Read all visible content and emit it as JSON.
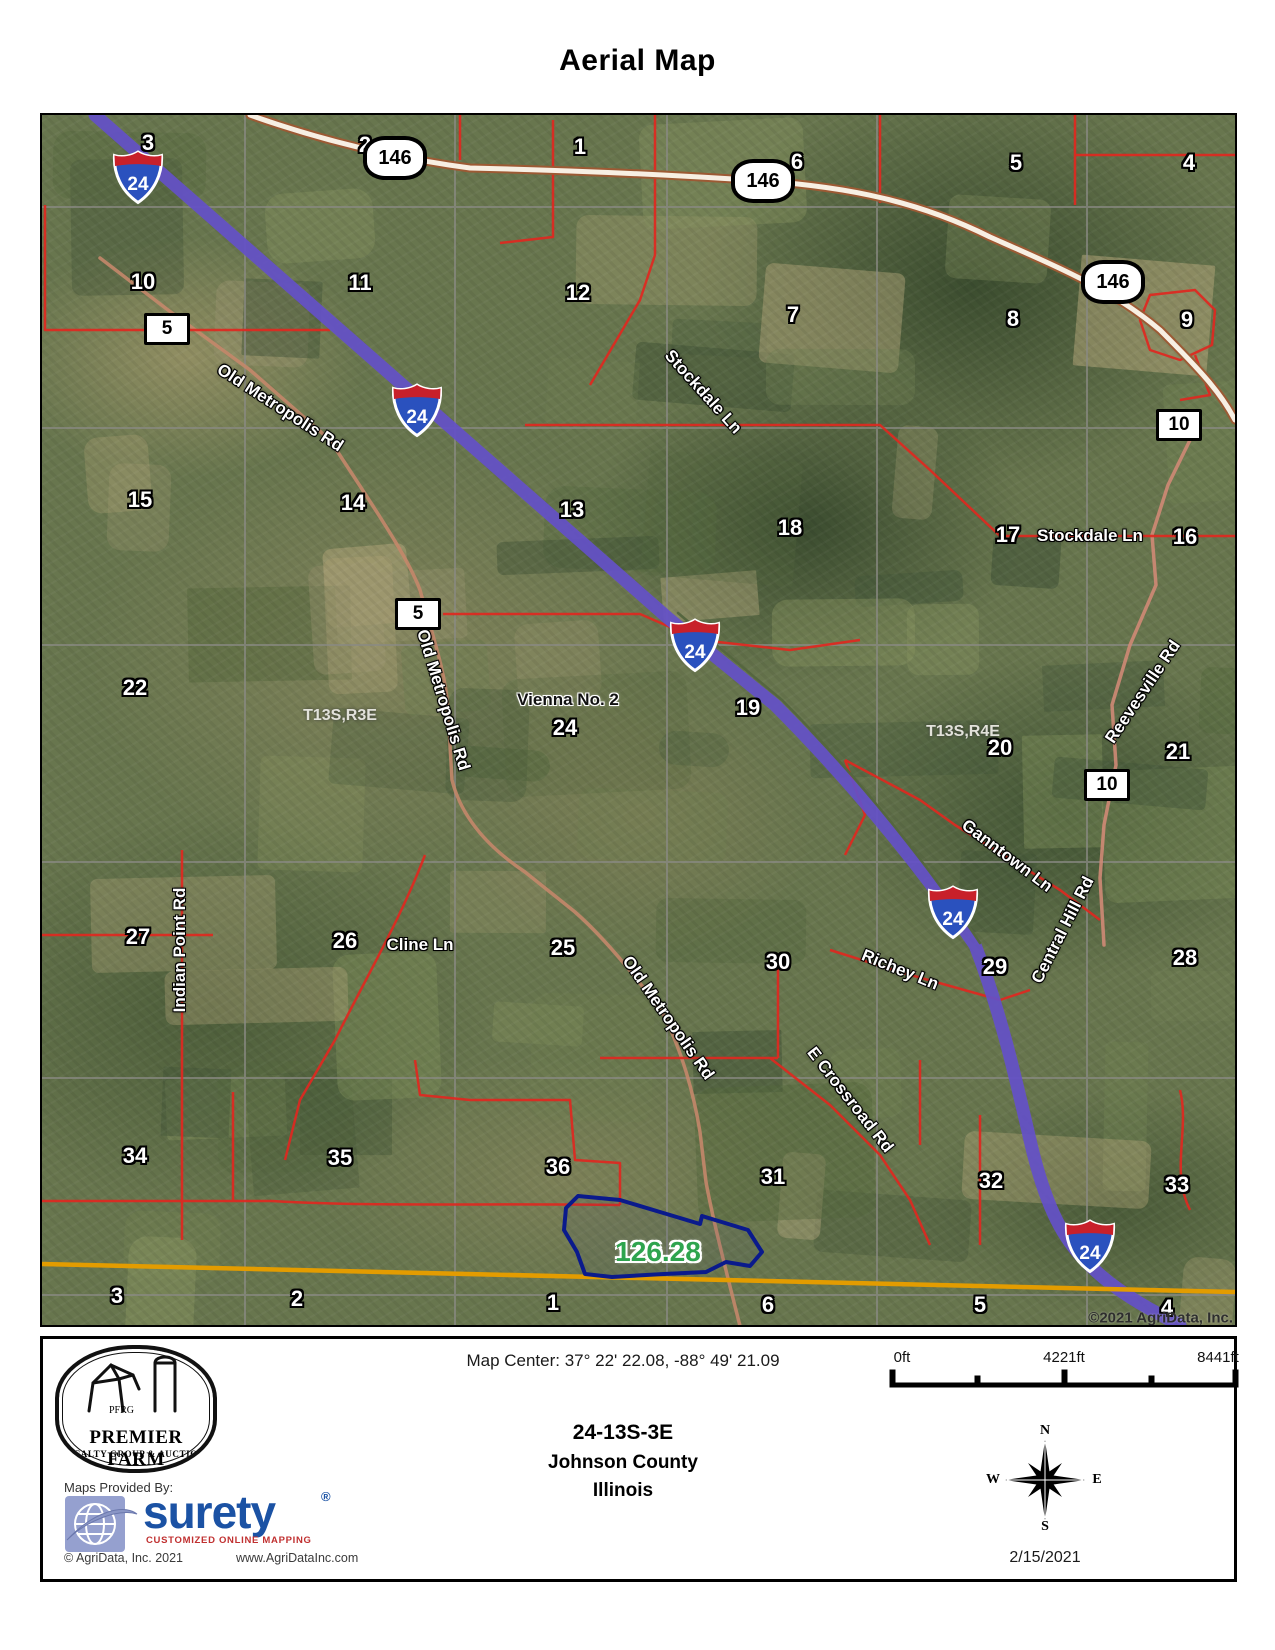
{
  "title": "Aerial Map",
  "map": {
    "copyright": "©2021 AgriData, Inc.",
    "place_label": "Vienna No. 2",
    "parcel_acres": "126.28",
    "township_labels": [
      "T13S,R3E",
      "T13S,R4E"
    ],
    "interstate_shield": "24",
    "route_shield": "146",
    "county_markers": [
      "5",
      "5",
      "10",
      "10"
    ],
    "section_numbers": [
      "3",
      "2",
      "1",
      "6",
      "5",
      "4",
      "10",
      "11",
      "12",
      "7",
      "8",
      "9",
      "15",
      "14",
      "13",
      "18",
      "17",
      "16",
      "22",
      "24",
      "19",
      "20",
      "21",
      "27",
      "26",
      "25",
      "30",
      "29",
      "28",
      "34",
      "35",
      "36",
      "31",
      "32",
      "33",
      "3",
      "2",
      "1",
      "6",
      "5",
      "4"
    ],
    "road_labels": [
      "Old Metropolis Rd",
      "Old Metropolis Rd",
      "Old Metropolis Rd",
      "Stockdale Ln",
      "Stockdale Ln",
      "Indian Point Rd",
      "Cline Ln",
      "Ganntown Ln",
      "Central Hill Rd",
      "Richey Ln",
      "E Crossroad Rd",
      "Reevesville Rd"
    ]
  },
  "footer": {
    "map_center": "Map Center: 37° 22' 22.08,  -88° 49' 21.09",
    "trs": "24-13S-3E",
    "county": "Johnson County",
    "state": "Illinois",
    "scale": {
      "start": "0ft",
      "mid": "4221ft",
      "end": "8441ft"
    },
    "compass": {
      "n": "N",
      "s": "S",
      "e": "E",
      "w": "W"
    },
    "date": "2/15/2021",
    "logo": {
      "initials": "PFRG",
      "name": "PREMIER FARM",
      "tagline": "REALTY GROUP & AUCTION"
    },
    "provider": {
      "label": "Maps Provided By:",
      "brand": "surety",
      "reg": "®",
      "tagline": "CUSTOMIZED ONLINE MAPPING",
      "copyright": "© AgriData, Inc.  2021",
      "website": "www.AgriDataInc.com"
    }
  }
}
